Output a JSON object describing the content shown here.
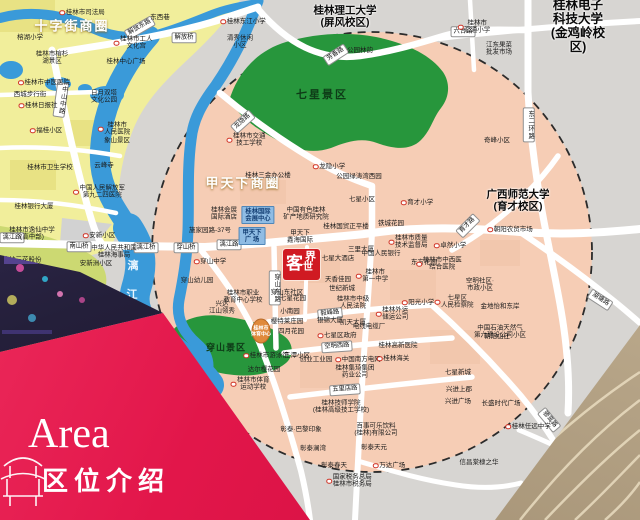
{
  "banner": {
    "title_en": "Area",
    "title_zh": "区位介绍"
  },
  "logo": {
    "c1": "客",
    "c2": "世",
    "c3": "界",
    "full": "客世界"
  },
  "colors": {
    "banner_red": "#e2164a",
    "logo_red": "#d01a22",
    "circle_pink": "#f6cdb5",
    "outer_grey": "#d7d5d2",
    "block_yellow": "#f1ee9b",
    "block_lime": "#ccd972",
    "park_green": "#27963c",
    "river_blue": "#3a9ad9",
    "road_white": "#ffffff",
    "poi_red": "#d03325",
    "bluebox_blue": "#8fbce4"
  },
  "map": {
    "labels": [
      {
        "t": "十字街商圈",
        "x": 72,
        "y": 27,
        "c": "biz"
      },
      {
        "t": "甲天下商圈",
        "x": 243,
        "y": 184,
        "c": "biz"
      },
      {
        "t": "联达商圈",
        "x": 50,
        "y": 278,
        "c": "biz2"
      },
      {
        "t": "七星景区",
        "x": 322,
        "y": 95,
        "c": "park"
      },
      {
        "t": "穿山景区",
        "x": 226,
        "y": 347,
        "c": "park2"
      },
      {
        "t": "桂林理工大学\n(屏风校区)",
        "x": 345,
        "y": 17,
        "c": "uni"
      },
      {
        "t": "桂林电子科技大学\n(金鸡岭校区)",
        "x": 578,
        "y": 26,
        "c": "unil"
      },
      {
        "t": "广西师范大学\n(育才校区)",
        "x": 518,
        "y": 201,
        "c": "uni"
      },
      {
        "t": "漓",
        "x": 133,
        "y": 266,
        "c": "river"
      },
      {
        "t": "江",
        "x": 132,
        "y": 295,
        "c": "river"
      },
      {
        "t": "解放东路",
        "x": 140,
        "y": 28,
        "c": "road",
        "a": -30
      },
      {
        "t": "解放桥",
        "x": 184,
        "y": 38,
        "c": "road"
      },
      {
        "t": "六合路",
        "x": 463,
        "y": 32,
        "c": "road"
      },
      {
        "t": "芳香路",
        "x": 336,
        "y": 55,
        "c": "road",
        "a": -33
      },
      {
        "t": "龙隐路",
        "x": 243,
        "y": 122,
        "c": "road",
        "a": -42
      },
      {
        "t": "中山中路",
        "x": 61,
        "y": 100,
        "c": "roadv",
        "a": 8
      },
      {
        "t": "漓江路",
        "x": 12,
        "y": 238,
        "c": "road"
      },
      {
        "t": "漓江路",
        "x": 229,
        "y": 245,
        "c": "road"
      },
      {
        "t": "南山桥",
        "x": 79,
        "y": 247,
        "c": "road"
      },
      {
        "t": "漓江桥",
        "x": 146,
        "y": 248,
        "c": "road"
      },
      {
        "t": "穿山桥",
        "x": 186,
        "y": 248,
        "c": "road"
      },
      {
        "t": "穿山东路",
        "x": 275,
        "y": 288,
        "c": "roadv"
      },
      {
        "t": "毅峰路",
        "x": 330,
        "y": 314,
        "c": "road",
        "a": -6
      },
      {
        "t": "空明西路",
        "x": 337,
        "y": 347,
        "c": "road",
        "a": -4
      },
      {
        "t": "五里店路",
        "x": 345,
        "y": 390,
        "c": "road",
        "a": -4
      },
      {
        "t": "育才路",
        "x": 468,
        "y": 226,
        "c": "road",
        "a": -45
      },
      {
        "t": "湖塘路",
        "x": 600,
        "y": 300,
        "c": "road",
        "a": 33
      },
      {
        "t": "骖鸾路",
        "x": 549,
        "y": 420,
        "c": "road",
        "a": 50
      },
      {
        "t": "东二环路",
        "x": 529,
        "y": 125,
        "c": "roadv"
      },
      {
        "t": "桂林国际\n会展中心",
        "x": 258,
        "y": 215,
        "c": "bluebox"
      },
      {
        "t": "甲天下\n广 场",
        "x": 252,
        "y": 236,
        "c": "bluebox"
      },
      {
        "t": "桂林市\n体育中心",
        "x": 261,
        "y": 332,
        "c": "stadium"
      },
      {
        "t": "桂林市司法局",
        "x": 82,
        "y": 13,
        "d": 1
      },
      {
        "t": "榕湖小学",
        "x": 30,
        "y": 38
      },
      {
        "t": "东西巷",
        "x": 160,
        "y": 18
      },
      {
        "t": "桂林东江小学",
        "x": 243,
        "y": 22,
        "d": 1
      },
      {
        "t": "清秀休闲\n小区",
        "x": 240,
        "y": 42
      },
      {
        "t": "桂林市工人\n文化宫",
        "x": 133,
        "y": 43,
        "d": 1
      },
      {
        "t": "桂林中心广场",
        "x": 126,
        "y": 62
      },
      {
        "t": "桂林市榕杉\n湖景区",
        "x": 52,
        "y": 58
      },
      {
        "t": "桂林市中医医院",
        "x": 44,
        "y": 83,
        "d": 1
      },
      {
        "t": "西城步行街",
        "x": 30,
        "y": 95
      },
      {
        "t": "桂林日报社",
        "x": 38,
        "y": 106,
        "d": 1
      },
      {
        "t": "日月双塔\n文化公园",
        "x": 104,
        "y": 97
      },
      {
        "t": "福桂小区",
        "x": 46,
        "y": 131,
        "d": 1
      },
      {
        "t": "桂林市\n人民医院",
        "x": 114,
        "y": 129,
        "d": 1
      },
      {
        "t": "象山景区",
        "x": 117,
        "y": 141
      },
      {
        "t": "云峰寺",
        "x": 104,
        "y": 166
      },
      {
        "t": "桂林市卫生学校",
        "x": 50,
        "y": 168
      },
      {
        "t": "中国人民解放军\n第九二四医院",
        "x": 99,
        "y": 192,
        "d": 1
      },
      {
        "t": "桂林银行大厦",
        "x": 34,
        "y": 207
      },
      {
        "t": "桂林市逸仙中学\n(高中部)",
        "x": 32,
        "y": 234
      },
      {
        "t": "安新小区",
        "x": 99,
        "y": 236,
        "d": 1
      },
      {
        "t": "中华人民共和国\n桂林海事局",
        "x": 114,
        "y": 252
      },
      {
        "t": "安新洲小区",
        "x": 96,
        "y": 264
      },
      {
        "t": "桂林三花股份\n公司",
        "x": 22,
        "y": 264
      },
      {
        "t": "安新小区·南区",
        "x": 90,
        "y": 308
      },
      {
        "t": "桂林市交通\n技工学校",
        "x": 246,
        "y": 140,
        "d": 1
      },
      {
        "t": "龙隐小学",
        "x": 329,
        "y": 167,
        "d": 1
      },
      {
        "t": "桂林三金办公楼",
        "x": 268,
        "y": 176
      },
      {
        "t": "公园绿涛湾西园",
        "x": 359,
        "y": 177
      },
      {
        "t": "公园林韵",
        "x": 360,
        "y": 51
      },
      {
        "t": "七星小区",
        "x": 362,
        "y": 200
      },
      {
        "t": "桂林市\n汇通小学",
        "x": 474,
        "y": 27,
        "d": 1
      },
      {
        "t": "江东果菜\n批发市场",
        "x": 499,
        "y": 49
      },
      {
        "t": "奇峰小区",
        "x": 497,
        "y": 141
      },
      {
        "t": "桂林会展\n国际酒店",
        "x": 224,
        "y": 214
      },
      {
        "t": "施家园路-37号",
        "x": 210,
        "y": 231
      },
      {
        "t": "中国有色桂林\n矿产地质研究院",
        "x": 306,
        "y": 214
      },
      {
        "t": "桂林国贸正平楼",
        "x": 346,
        "y": 227
      },
      {
        "t": "甲天下\n鑫海国际",
        "x": 300,
        "y": 237
      },
      {
        "t": "穿山中学",
        "x": 210,
        "y": 262,
        "d": 1
      },
      {
        "t": "穿山幼儿园",
        "x": 197,
        "y": 281
      },
      {
        "t": "桂林市职业\n教育中心学校",
        "x": 243,
        "y": 297
      },
      {
        "t": "兴达\n江山领秀",
        "x": 222,
        "y": 308
      },
      {
        "t": "桂林市游泳馆",
        "x": 266,
        "y": 356,
        "d": 1
      },
      {
        "t": "达尔樱花园",
        "x": 264,
        "y": 370
      },
      {
        "t": "桂林市体育\n运动学校",
        "x": 250,
        "y": 384,
        "d": 1
      },
      {
        "t": "三潭小区",
        "x": 297,
        "y": 356
      },
      {
        "t": "创业工业园",
        "x": 316,
        "y": 360
      },
      {
        "t": "中国南方电网",
        "x": 358,
        "y": 360,
        "d": 1
      },
      {
        "t": "桂林海关",
        "x": 393,
        "y": 359,
        "d": 1
      },
      {
        "t": "桂林高新医院",
        "x": 398,
        "y": 346
      },
      {
        "t": "桂林集琦集团\n药业公司",
        "x": 355,
        "y": 372
      },
      {
        "t": "桂林技师学院\n(桂林高级技工学校)",
        "x": 341,
        "y": 407
      },
      {
        "t": "彰泰·巴黎印象",
        "x": 301,
        "y": 430
      },
      {
        "t": "百事可乐饮料\n(桂林)有限公司",
        "x": 376,
        "y": 430
      },
      {
        "t": "彰泰澜湾",
        "x": 313,
        "y": 449
      },
      {
        "t": "彰泰天元",
        "x": 374,
        "y": 448
      },
      {
        "t": "彰泰春天",
        "x": 334,
        "y": 466
      },
      {
        "t": "万达广场",
        "x": 389,
        "y": 466,
        "d": 1
      },
      {
        "t": "国家税务总局\n桂林市税务局",
        "x": 349,
        "y": 481,
        "d": 1
      },
      {
        "t": "樱特莱庄园",
        "x": 287,
        "y": 322
      },
      {
        "t": "四月花园",
        "x": 291,
        "y": 332
      },
      {
        "t": "银锦大厦",
        "x": 330,
        "y": 321
      },
      {
        "t": "凯天大厦",
        "x": 353,
        "y": 323
      },
      {
        "t": "七星区政府",
        "x": 337,
        "y": 336,
        "d": 1
      },
      {
        "t": "电线电缆厂",
        "x": 369,
        "y": 327
      },
      {
        "t": "桂林外运\n储运公司",
        "x": 392,
        "y": 314,
        "d": 1
      },
      {
        "t": "中国石油天然气\n第六建设公司小区",
        "x": 500,
        "y": 332
      },
      {
        "t": "七星大酒店",
        "x": 338,
        "y": 259
      },
      {
        "t": "三里大厦",
        "x": 361,
        "y": 250
      },
      {
        "t": "中国人民银行",
        "x": 381,
        "y": 254
      },
      {
        "t": "天香佳园",
        "x": 338,
        "y": 280
      },
      {
        "t": "世纪新城",
        "x": 342,
        "y": 289
      },
      {
        "t": "桂林市中级\n人民法院",
        "x": 353,
        "y": 303
      },
      {
        "t": "桂林市\n第一中学",
        "x": 372,
        "y": 276,
        "d": 1
      },
      {
        "t": "东方花园",
        "x": 424,
        "y": 263
      },
      {
        "t": "穿山东社区",
        "x": 287,
        "y": 293
      },
      {
        "t": "七星花园",
        "x": 293,
        "y": 299
      },
      {
        "t": "小南园",
        "x": 290,
        "y": 312
      },
      {
        "t": "桂林市质量\n技术监督局",
        "x": 408,
        "y": 242,
        "d": 1
      },
      {
        "t": "铁城花园",
        "x": 391,
        "y": 224
      },
      {
        "t": "育才小学",
        "x": 417,
        "y": 203,
        "d": 1
      },
      {
        "t": "卓然小学",
        "x": 450,
        "y": 246,
        "d": 1
      },
      {
        "t": "桂林市中西医\n结合医院",
        "x": 439,
        "y": 264,
        "d": 1
      },
      {
        "t": "朝阳农贸市场",
        "x": 510,
        "y": 230,
        "d": 1
      },
      {
        "t": "阳光小学",
        "x": 418,
        "y": 303,
        "d": 1
      },
      {
        "t": "空明社区·\n市政小区",
        "x": 480,
        "y": 285
      },
      {
        "t": "七星区\n人民检察院",
        "x": 454,
        "y": 302,
        "d": 1
      },
      {
        "t": "金地怡和东岸",
        "x": 500,
        "y": 307
      },
      {
        "t": "朝阳山庄",
        "x": 497,
        "y": 337
      },
      {
        "t": "七星新城",
        "x": 458,
        "y": 373
      },
      {
        "t": "兴进上郡",
        "x": 459,
        "y": 390
      },
      {
        "t": "兴进广场",
        "x": 458,
        "y": 402
      },
      {
        "t": "长盛时代广场",
        "x": 501,
        "y": 404
      },
      {
        "t": "桂林任远中学",
        "x": 528,
        "y": 427,
        "d": 1
      },
      {
        "t": "信昌棠棣之华",
        "x": 479,
        "y": 463
      }
    ]
  }
}
